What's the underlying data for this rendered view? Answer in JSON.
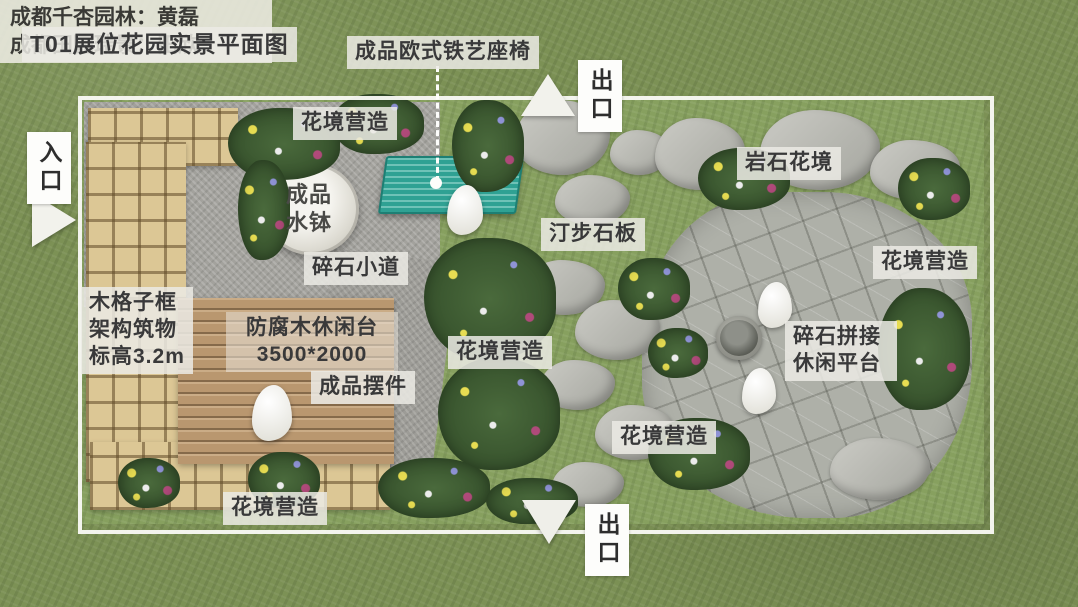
{
  "title": "T01展位花园实景平面图",
  "markers": {
    "entrance": "入口",
    "exit_top": "出口",
    "exit_bottom": "出口"
  },
  "labels": {
    "iron_bench": "成品欧式铁艺座椅",
    "flower_border_top": "花境营造",
    "water_bowl": "成品水钵",
    "rock_flower_border": "岩石花境",
    "stepping_stones": "汀步石板",
    "gravel_path": "碎石小道",
    "flower_border_right": "花境营造",
    "lattice_structure": "木格子框架构筑物",
    "lattice_elevation": "标高3.2m",
    "wood_deck": "防腐木休闲台",
    "wood_deck_size": "3500*2000",
    "ornament": "成品摆件",
    "flower_border_center": "花境营造",
    "gravel_platform": "碎石拼接休闲平台",
    "flower_border_mid": "花境营造",
    "flower_border_bottom": "花境营造"
  },
  "credits": [
    "成都千杏园林：黄磊",
    "成都田园瑞景：田欣"
  ],
  "colors": {
    "label_bg": "#ebeae4",
    "label_text": "#39393a",
    "grass": "#7c9155",
    "gravel": "#a3a29d",
    "bench_teal": "#2fa193",
    "deck_wood": "#b9976f",
    "lattice_wood": "#dcc795",
    "rock": "#aeb0a8",
    "marker_white": "#fdfdfb"
  }
}
